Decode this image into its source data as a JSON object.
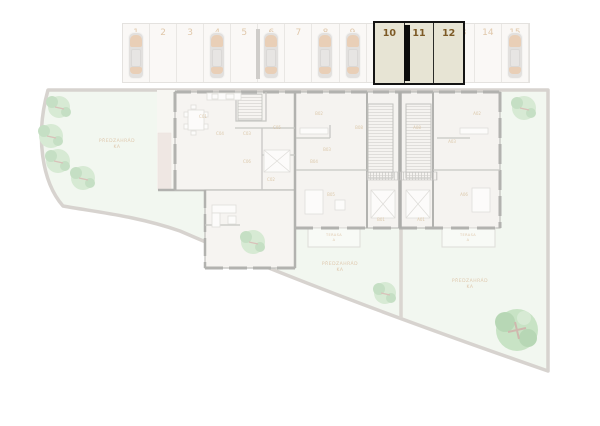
{
  "parking": {
    "stalls": [
      {
        "label": "1",
        "occupied": true,
        "selected": false
      },
      {
        "label": "2",
        "occupied": false,
        "selected": false
      },
      {
        "label": "3",
        "occupied": false,
        "selected": false
      },
      {
        "label": "4",
        "occupied": true,
        "selected": false
      },
      {
        "label": "5",
        "occupied": false,
        "selected": false
      },
      {
        "label": "6",
        "occupied": true,
        "selected": false
      },
      {
        "label": "7",
        "occupied": false,
        "selected": false
      },
      {
        "label": "8",
        "occupied": true,
        "selected": false
      },
      {
        "label": "9",
        "occupied": true,
        "selected": false
      },
      {
        "label": "10",
        "occupied": false,
        "selected": true
      },
      {
        "label": "11",
        "occupied": false,
        "selected": true
      },
      {
        "label": "12",
        "occupied": false,
        "selected": true
      },
      {
        "label": "13",
        "occupied": false,
        "selected": false
      },
      {
        "label": "14",
        "occupied": false,
        "selected": false
      },
      {
        "label": "15",
        "occupied": true,
        "selected": false
      }
    ]
  },
  "site": {
    "garden_labels": [
      {
        "line1": "PŘEDZAHRÁD",
        "line2": "KA"
      },
      {
        "line1": "PŘEDZAHRÁD",
        "line2": "KA"
      },
      {
        "line1": "PŘEDZAHRÁD",
        "line2": "KA"
      }
    ],
    "terrace_labels": [
      {
        "line1": "TERASA",
        "line2": "A"
      },
      {
        "line1": "TERASA",
        "line2": "A"
      }
    ]
  },
  "building": {
    "room_labels": [
      "C01",
      "C04",
      "C03",
      "C05",
      "C06",
      "C02",
      "B02",
      "B08",
      "B03",
      "B04",
      "B05",
      "B01",
      "A02",
      "A08",
      "A03",
      "A06",
      "A01"
    ]
  },
  "colors": {
    "selected_fill": "#e7e4d4",
    "selected_border": "#141414",
    "selected_number": "#7d5a26",
    "stall_number": "#c89b66",
    "lawn": "#e9f1e4",
    "path": "#b7b0a8",
    "tree": "#b7d9b2",
    "tree_dark": "#97c694",
    "big_tree": "#9ccd97",
    "wall": "#75756f",
    "car_body": "#cbc8c4",
    "car_accent": "#d8a97e"
  }
}
